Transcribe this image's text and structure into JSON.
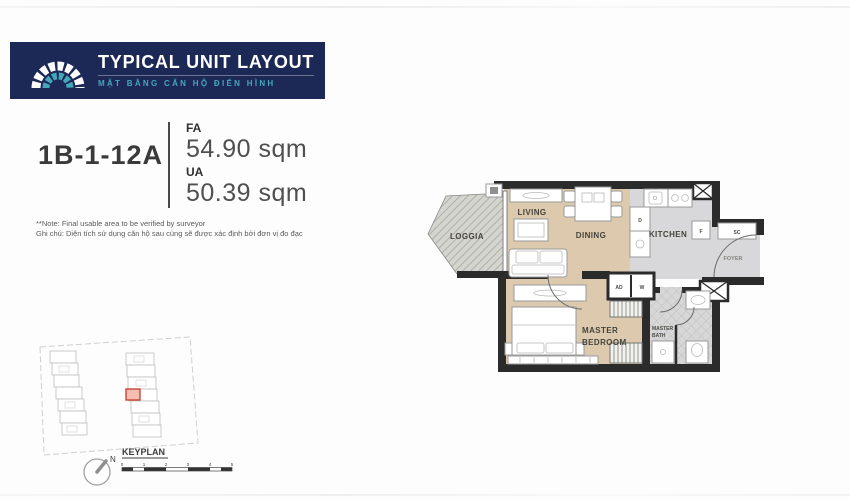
{
  "header": {
    "title": "TYPICAL UNIT LAYOUT",
    "subtitle": "MẶT BẰNG CĂN HỘ ĐIỂN HÌNH"
  },
  "unit": {
    "code": "1B-1-12A",
    "fa_label": "FA",
    "fa_value": "54.90 sqm",
    "ua_label": "UA",
    "ua_value": "50.39 sqm"
  },
  "notes": {
    "line1": "**Note: Final usable area to be verified by surveyor",
    "line2": "Ghi chú: Diện tích sử dụng căn hộ sau cùng sẽ được xác định bởi đơn vị đo đạc"
  },
  "floorplan": {
    "labels": {
      "loggia": "LOGGIA",
      "living": "LIVING",
      "dining": "DINING",
      "kitchen": "KITCHEN",
      "foyer": "FOYER",
      "master_bedroom_line1": "MASTER",
      "master_bedroom_line2": "BEDROOM",
      "master_bath_line1": "MASTER",
      "master_bath_line2": "BATH",
      "dishwasher": "D",
      "fridge": "F",
      "shoe_cabinet": "SC",
      "ac_duct": "AD",
      "washer": "W"
    }
  },
  "keyplan": {
    "title": "KEYPLAN",
    "north": "N",
    "scale_ticks": [
      "0",
      "1",
      "2",
      "3",
      "4",
      "5"
    ]
  },
  "colors": {
    "navy": "#1c2957",
    "teal": "#46a6ba",
    "wall": "#2b2b2b",
    "wood": "#dcc9ae",
    "grayfloor": "#d8d8da",
    "highlight": "#c23b2a"
  }
}
